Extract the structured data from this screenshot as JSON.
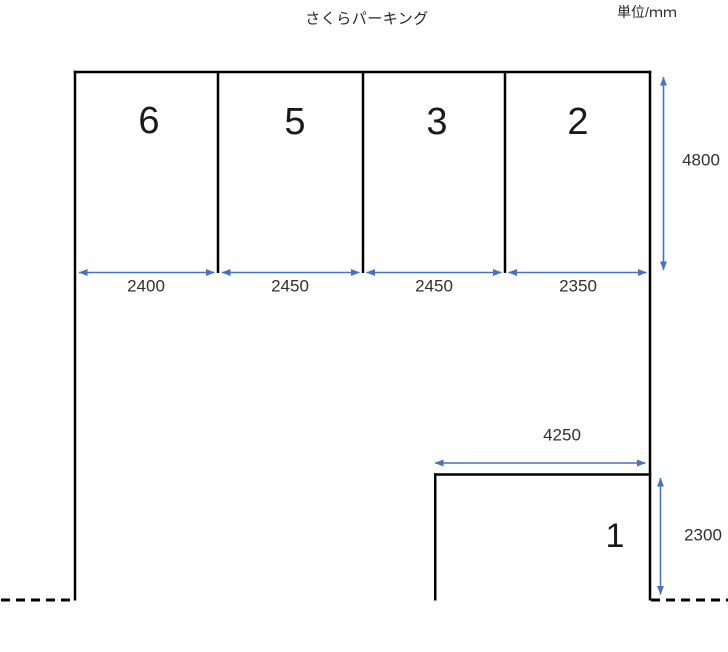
{
  "diagram": {
    "title": "さくらパーキング",
    "unit_label": "単位/ｍｍ",
    "stalls": [
      {
        "number": "6",
        "width_mm": "2400"
      },
      {
        "number": "5",
        "width_mm": "2450"
      },
      {
        "number": "3",
        "width_mm": "2450"
      },
      {
        "number": "2",
        "width_mm": "2350"
      }
    ],
    "row_depth_mm": "4800",
    "corner_stall": {
      "number": "1",
      "width_mm": "4250",
      "depth_mm": "2300"
    },
    "colors": {
      "wall": "#000000",
      "dimension_arrow": "#4472C4",
      "text": "#262626"
    }
  }
}
